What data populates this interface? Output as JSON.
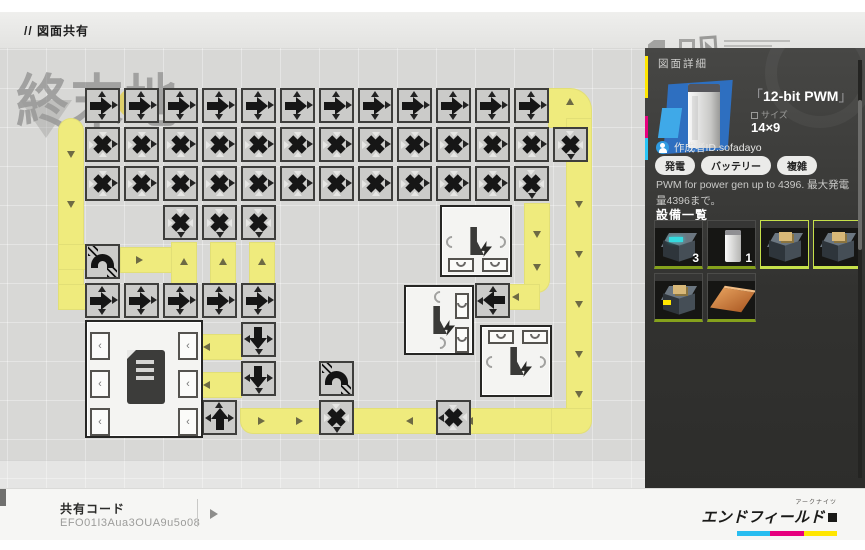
{
  "header": {
    "title": "// 図面共有"
  },
  "watermark": {
    "text": "終末地"
  },
  "sidebar": {
    "panel_title": "図面詳細",
    "blueprint": {
      "bracket_open": "「",
      "title": "12-bit PWM",
      "bracket_close": "」",
      "size_label": "サイズ",
      "size_value": "14×9"
    },
    "creator": {
      "label": "作成者ID.sofadayo"
    },
    "tags": [
      {
        "label": "発電"
      },
      {
        "label": "バッテリー"
      },
      {
        "label": "複雑"
      }
    ],
    "description": "PWM for power gen up to 4396. 最大発電量4396まで。",
    "equipment_title": "設備一覧",
    "equipment": [
      {
        "name": "equipment-generator",
        "icon": "gen",
        "count": "3",
        "selected": false
      },
      {
        "name": "equipment-battery",
        "icon": "tower",
        "count": "1",
        "selected": false
      },
      {
        "name": "equipment-relay",
        "icon": "relay",
        "count": "",
        "selected": true
      },
      {
        "name": "equipment-relay",
        "icon": "relay",
        "count": "",
        "selected": true
      },
      {
        "name": "equipment-relay-alt",
        "icon": "relay2",
        "count": "",
        "selected": false
      },
      {
        "name": "equipment-conveyor-plate",
        "icon": "plate",
        "count": "",
        "selected": false
      }
    ]
  },
  "share": {
    "label": "共有コード",
    "code": "EFO01I3Aua3OUA9u5o08"
  },
  "brand": {
    "ruby": "アークナイツ",
    "name": "エンドフィールド",
    "colors": [
      "#29bdf0",
      "#e6007e",
      "#ffe600"
    ]
  },
  "colors": {
    "belt_yellow": "#efeb7d",
    "accent_lime": "#c6e04a",
    "sidebar_dark": "#323230"
  },
  "factory": {
    "belts": [
      {
        "x": 58,
        "y": 118,
        "w": 26,
        "h": 192,
        "r": "13px 13px 13px 0"
      },
      {
        "x": 58,
        "y": 244,
        "w": 32,
        "h": 26,
        "r": ""
      },
      {
        "x": 58,
        "y": 284,
        "w": 32,
        "h": 26,
        "r": ""
      },
      {
        "x": 120,
        "y": 247,
        "w": 56,
        "h": 26,
        "r": ""
      },
      {
        "x": 171,
        "y": 242,
        "w": 26,
        "h": 44,
        "r": ""
      },
      {
        "x": 210,
        "y": 242,
        "w": 26,
        "h": 44,
        "r": ""
      },
      {
        "x": 249,
        "y": 242,
        "w": 26,
        "h": 44,
        "r": ""
      },
      {
        "x": 548,
        "y": 88,
        "w": 44,
        "h": 40,
        "r": "0 22px 0 0"
      },
      {
        "x": 566,
        "y": 118,
        "w": 26,
        "h": 296,
        "r": ""
      },
      {
        "x": 548,
        "y": 408,
        "w": 44,
        "h": 26,
        "r": "0 0 13px 0"
      },
      {
        "x": 240,
        "y": 408,
        "w": 312,
        "h": 26,
        "r": "0 0 0 13px"
      },
      {
        "x": 524,
        "y": 203,
        "w": 26,
        "h": 90,
        "r": "0 0 13px 0"
      },
      {
        "x": 506,
        "y": 284,
        "w": 34,
        "h": 26,
        "r": ""
      },
      {
        "x": 190,
        "y": 334,
        "w": 52,
        "h": 26,
        "r": ""
      },
      {
        "x": 190,
        "y": 372,
        "w": 52,
        "h": 26,
        "r": ""
      }
    ],
    "arrows": [
      {
        "d": "down",
        "x": 71,
        "y": 155
      },
      {
        "d": "down",
        "x": 71,
        "y": 205
      },
      {
        "d": "right",
        "x": 140,
        "y": 260
      },
      {
        "d": "up",
        "x": 184,
        "y": 262
      },
      {
        "d": "up",
        "x": 223,
        "y": 262
      },
      {
        "d": "up",
        "x": 262,
        "y": 262
      },
      {
        "d": "up",
        "x": 570,
        "y": 102
      },
      {
        "d": "down",
        "x": 579,
        "y": 155
      },
      {
        "d": "down",
        "x": 579,
        "y": 205
      },
      {
        "d": "down",
        "x": 579,
        "y": 255
      },
      {
        "d": "down",
        "x": 579,
        "y": 305
      },
      {
        "d": "down",
        "x": 579,
        "y": 355
      },
      {
        "d": "down",
        "x": 579,
        "y": 395
      },
      {
        "d": "left",
        "x": 350,
        "y": 421
      },
      {
        "d": "left",
        "x": 410,
        "y": 421
      },
      {
        "d": "left",
        "x": 470,
        "y": 421
      },
      {
        "d": "right",
        "x": 262,
        "y": 421
      },
      {
        "d": "right",
        "x": 300,
        "y": 421
      },
      {
        "d": "down",
        "x": 537,
        "y": 235
      },
      {
        "d": "down",
        "x": 537,
        "y": 268
      },
      {
        "d": "left",
        "x": 516,
        "y": 297
      },
      {
        "d": "left",
        "x": 207,
        "y": 347
      },
      {
        "d": "left",
        "x": 207,
        "y": 385
      }
    ],
    "tiles": [
      {
        "t": "splitR",
        "x": 85,
        "y": 88
      },
      {
        "t": "splitR",
        "x": 124,
        "y": 88
      },
      {
        "t": "splitR",
        "x": 163,
        "y": 88
      },
      {
        "t": "splitR",
        "x": 202,
        "y": 88
      },
      {
        "t": "splitR",
        "x": 241,
        "y": 88
      },
      {
        "t": "splitR",
        "x": 280,
        "y": 88
      },
      {
        "t": "splitR",
        "x": 319,
        "y": 88
      },
      {
        "t": "splitR",
        "x": 358,
        "y": 88
      },
      {
        "t": "splitR",
        "x": 397,
        "y": 88
      },
      {
        "t": "splitR",
        "x": 436,
        "y": 88
      },
      {
        "t": "splitR",
        "x": 475,
        "y": 88
      },
      {
        "t": "splitR",
        "x": 514,
        "y": 88
      },
      {
        "t": "crossR",
        "x": 85,
        "y": 127
      },
      {
        "t": "crossR",
        "x": 124,
        "y": 127
      },
      {
        "t": "crossR",
        "x": 163,
        "y": 127
      },
      {
        "t": "crossR",
        "x": 202,
        "y": 127
      },
      {
        "t": "crossR",
        "x": 241,
        "y": 127
      },
      {
        "t": "crossR",
        "x": 280,
        "y": 127
      },
      {
        "t": "crossR",
        "x": 319,
        "y": 127
      },
      {
        "t": "crossR",
        "x": 358,
        "y": 127
      },
      {
        "t": "crossR",
        "x": 397,
        "y": 127
      },
      {
        "t": "crossR",
        "x": 436,
        "y": 127
      },
      {
        "t": "crossR",
        "x": 475,
        "y": 127
      },
      {
        "t": "crossR",
        "x": 514,
        "y": 127
      },
      {
        "t": "crossD",
        "x": 553,
        "y": 127
      },
      {
        "t": "crossR",
        "x": 85,
        "y": 166
      },
      {
        "t": "crossR",
        "x": 124,
        "y": 166
      },
      {
        "t": "crossR",
        "x": 163,
        "y": 166
      },
      {
        "t": "crossR",
        "x": 202,
        "y": 166
      },
      {
        "t": "crossR",
        "x": 241,
        "y": 166
      },
      {
        "t": "crossR",
        "x": 280,
        "y": 166
      },
      {
        "t": "crossR",
        "x": 319,
        "y": 166
      },
      {
        "t": "crossR",
        "x": 358,
        "y": 166
      },
      {
        "t": "crossR",
        "x": 397,
        "y": 166
      },
      {
        "t": "crossR",
        "x": 436,
        "y": 166
      },
      {
        "t": "crossR",
        "x": 475,
        "y": 166
      },
      {
        "t": "crossD",
        "x": 514,
        "y": 166
      },
      {
        "t": "crossD",
        "x": 163,
        "y": 205
      },
      {
        "t": "crossD",
        "x": 202,
        "y": 205
      },
      {
        "t": "crossD",
        "x": 241,
        "y": 205
      },
      {
        "t": "bridge",
        "x": 85,
        "y": 244
      },
      {
        "t": "splitR",
        "x": 85,
        "y": 283
      },
      {
        "t": "splitR",
        "x": 124,
        "y": 283
      },
      {
        "t": "splitR",
        "x": 163,
        "y": 283
      },
      {
        "t": "splitR",
        "x": 202,
        "y": 283
      },
      {
        "t": "splitR",
        "x": 241,
        "y": 283
      },
      {
        "t": "splitL",
        "x": 475,
        "y": 283
      },
      {
        "t": "splitD",
        "x": 241,
        "y": 322
      },
      {
        "t": "splitD",
        "x": 241,
        "y": 361
      },
      {
        "t": "bridge",
        "x": 319,
        "y": 361
      },
      {
        "t": "splitU",
        "x": 202,
        "y": 400
      },
      {
        "t": "crossD",
        "x": 319,
        "y": 400
      },
      {
        "t": "crossL",
        "x": 436,
        "y": 400
      }
    ],
    "machines": [
      {
        "kind": "storage",
        "x": 85,
        "y": 320,
        "w": 118,
        "h": 118
      },
      {
        "kind": "pp",
        "x": 440,
        "y": 205,
        "w": 72,
        "h": 72,
        "ports": "bottom"
      },
      {
        "kind": "pp",
        "x": 404,
        "y": 285,
        "w": 70,
        "h": 70,
        "ports": "right"
      },
      {
        "kind": "pp",
        "x": 480,
        "y": 325,
        "w": 72,
        "h": 72,
        "ports": "top"
      }
    ]
  }
}
